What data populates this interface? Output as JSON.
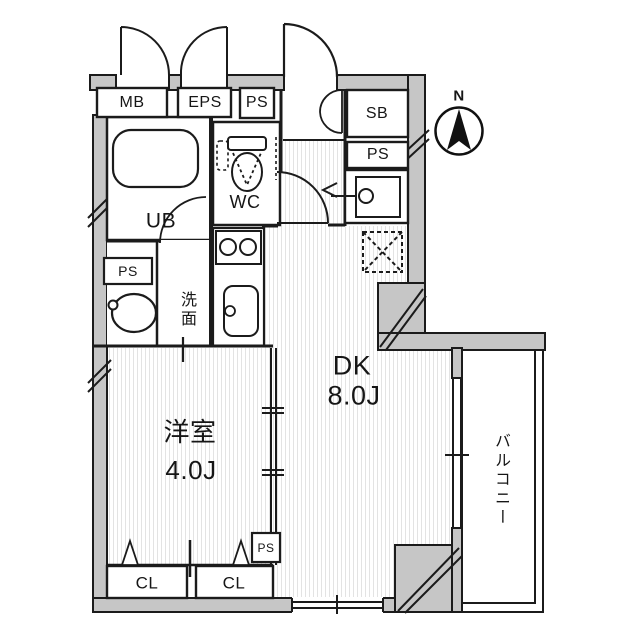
{
  "plan": {
    "north_label": "N",
    "rooms": {
      "dk": {
        "name": "DK",
        "size": "8.0J"
      },
      "western": {
        "name": "洋室",
        "size": "4.0J"
      },
      "balcony": {
        "name": "バルコニー"
      },
      "wc": {
        "name": "WC"
      },
      "unit_bath": {
        "name": "UB"
      },
      "washroom": {
        "name": "洗面"
      }
    },
    "shafts": {
      "mb": "MB",
      "eps": "EPS",
      "ps_top": "PS",
      "sb": "SB",
      "ps_right": "PS",
      "ps_washroom": "PS",
      "ps_bottom": "PS"
    },
    "closets": {
      "cl_left": "CL",
      "cl_right": "CL"
    },
    "colors": {
      "wall_fill": "#c6c6c6",
      "line": "#1b1b1b",
      "floor_stripe": "#e3e3e3"
    }
  }
}
